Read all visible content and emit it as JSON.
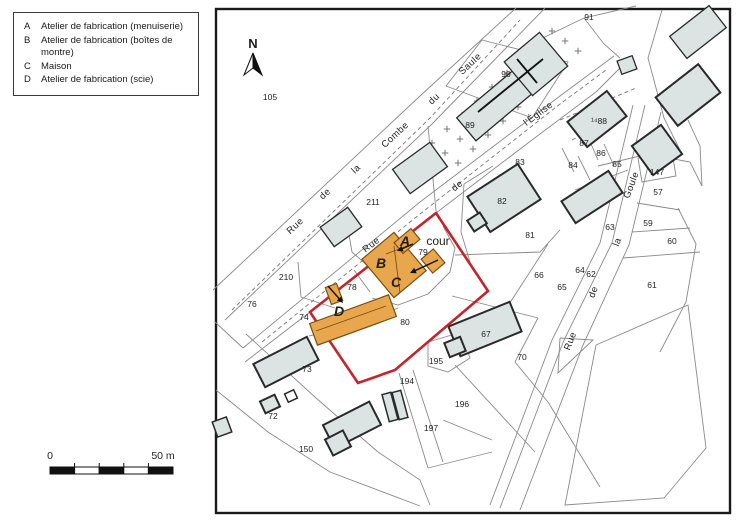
{
  "legend": {
    "items": [
      {
        "key": "A",
        "label": "Atelier de fabrication (menuiserie)"
      },
      {
        "key": "B",
        "label": "Atelier de fabrication (boîtes de montre)"
      },
      {
        "key": "C",
        "label": "Maison"
      },
      {
        "key": "D",
        "label": "Atelier de fabrication (scie)"
      }
    ]
  },
  "north_label": "N",
  "scale_bar": {
    "start_label": "0",
    "end_label": "50 m",
    "x0": 50,
    "x1": 173,
    "y": 467,
    "h": 7,
    "segments": 5
  },
  "colors": {
    "building_gray": "#dbe3e3",
    "building_gray_stroke": "#2a2a2a",
    "building_orange": "#e8a64d",
    "building_orange_stroke": "#7a4f12",
    "outline_red": "#c4242b",
    "parcel_line": "#8a8a8a",
    "frame": "#1a1a1a",
    "cross": "#777777",
    "label": "#1f1f1f"
  },
  "map": {
    "frame": {
      "x": 216,
      "y": 9,
      "w": 514,
      "h": 504
    },
    "red_outline": "436,213 488,291 395,370 358,383 310,312",
    "lines": [
      "213,290 420,96 516,8",
      "225,320 432,124 545,8",
      "243,348 420,202 560,96 614,56",
      "245,362 310,312",
      "436,213 532,140 596,92 624,64",
      "645,105 612,243 564,340 500,508",
      "661,112 629,245 583,345 520,510",
      "633,105 600,243 552,340 490,505",
      "637,203 680,210",
      "632,232 690,228",
      "623,258 700,252",
      "598,166 648,154 690,162 702,186",
      "678,208 696,244 686,302 660,352",
      "522,48 584,18 636,6",
      "584,18 604,44 620,58",
      "662,10 648,58 664,118 680,150",
      "688,120 700,146 702,186",
      "638,158 672,152 676,176 642,182 638,158",
      "493,166 464,184 461,232 470,262",
      "455,255 540,252 560,230",
      "548,244 515,295 492,330",
      "452,296 538,318",
      "538,318 515,362",
      "428,342 462,332 470,358 448,372 428,366 428,342",
      "399,373 428,468",
      "413,370 443,462",
      "443,420 492,440",
      "455,365 535,452",
      "428,468 492,452",
      "515,362 548,402",
      "548,402 600,487",
      "246,334 316,398 378,452",
      "216,390 268,432 330,472 420,506",
      "215,322 243,348",
      "298,262 301,297",
      "301,297 335,308",
      "345,212 352,252 368,266",
      "428,126 436,211",
      "372,298 398,305 428,294 450,272 455,248 443,226",
      "354,270 370,292",
      "309,336 355,325 398,308",
      "446,86 482,40 568,62 532,118 446,86",
      "596,345 688,305 706,448 664,498 565,505 596,345",
      "560,338 593,340 558,373 560,338",
      "588,137 598,160",
      "604,144 614,166",
      "578,156 590,180",
      "562,148 574,172",
      "575,190 628,170",
      "378,452 420,480 430,505"
    ],
    "dashed_lines": [
      "232,310 430,118 520,20",
      "262,342 420,214 560,104 606,70",
      "560,120 636,88",
      "572,140 612,120",
      "398,246 378,262"
    ],
    "crosses": [
      [
        432,
        143
      ],
      [
        447,
        129
      ],
      [
        462,
        115
      ],
      [
        477,
        101
      ],
      [
        492,
        87
      ],
      [
        507,
        73
      ],
      [
        522,
        59
      ],
      [
        537,
        45
      ],
      [
        552,
        31
      ],
      [
        445,
        153
      ],
      [
        460,
        139
      ],
      [
        475,
        125
      ],
      [
        490,
        111
      ],
      [
        505,
        97
      ],
      [
        520,
        83
      ],
      [
        535,
        69
      ],
      [
        550,
        55
      ],
      [
        565,
        41
      ],
      [
        458,
        163
      ],
      [
        473,
        149
      ],
      [
        488,
        135
      ],
      [
        503,
        121
      ],
      [
        518,
        107
      ],
      [
        533,
        93
      ],
      [
        548,
        79
      ],
      [
        563,
        65
      ],
      [
        578,
        51
      ]
    ],
    "gray_buildings": [
      {
        "name": "church-nave",
        "x": 500,
        "y": 101,
        "w": 88,
        "h": 30,
        "a": -40,
        "s": 1.3
      },
      {
        "name": "church-choir",
        "x": 536,
        "y": 64,
        "w": 46,
        "h": 44,
        "a": -40,
        "s": 1.3
      },
      {
        "name": "building-211",
        "x": 420,
        "y": 168,
        "w": 46,
        "h": 30,
        "a": -36,
        "s": 1.3
      },
      {
        "name": "building-210",
        "x": 341,
        "y": 227,
        "w": 34,
        "h": 24,
        "a": -36,
        "s": 1.3
      },
      {
        "name": "building-82",
        "x": 504,
        "y": 198,
        "w": 60,
        "h": 42,
        "a": -33,
        "s": 2
      },
      {
        "name": "building-82-annex",
        "x": 477,
        "y": 222,
        "w": 15,
        "h": 13,
        "a": -33,
        "s": 2
      },
      {
        "name": "building-85",
        "x": 592,
        "y": 197,
        "w": 56,
        "h": 26,
        "a": -33,
        "s": 2
      },
      {
        "name": "building-88",
        "x": 597,
        "y": 119,
        "w": 50,
        "h": 32,
        "a": -38,
        "s": 2
      },
      {
        "name": "building-147",
        "x": 657,
        "y": 150,
        "w": 36,
        "h": 36,
        "a": -36,
        "s": 2
      },
      {
        "name": "building-top-right",
        "x": 698,
        "y": 32,
        "w": 50,
        "h": 28,
        "a": -38,
        "s": 1.3
      },
      {
        "name": "fountain",
        "x": 627,
        "y": 65,
        "w": 16,
        "h": 14,
        "a": -20,
        "s": 1.3
      },
      {
        "name": "building-right-cluster",
        "x": 688,
        "y": 95,
        "w": 54,
        "h": 36,
        "a": -38,
        "s": 2
      },
      {
        "name": "building-67",
        "x": 485,
        "y": 329,
        "w": 66,
        "h": 32,
        "a": -22,
        "s": 2
      },
      {
        "name": "building-67-annex",
        "x": 455,
        "y": 347,
        "w": 17,
        "h": 15,
        "a": -22,
        "s": 2
      },
      {
        "name": "building-73",
        "x": 286,
        "y": 362,
        "w": 60,
        "h": 26,
        "a": -27,
        "s": 2
      },
      {
        "name": "building-72a",
        "x": 270,
        "y": 404,
        "w": 16,
        "h": 13,
        "a": -25,
        "s": 2
      },
      {
        "name": "building-72b",
        "x": 291,
        "y": 396,
        "w": 10,
        "h": 9,
        "a": -25,
        "s": 1.5,
        "fill": "#ffffff"
      },
      {
        "name": "building-150",
        "x": 352,
        "y": 425,
        "w": 52,
        "h": 26,
        "a": -27,
        "s": 2
      },
      {
        "name": "building-150-annex",
        "x": 338,
        "y": 443,
        "w": 20,
        "h": 18,
        "a": -27,
        "s": 2
      },
      {
        "name": "building-194a",
        "x": 390,
        "y": 407,
        "w": 9,
        "h": 28,
        "a": -15,
        "s": 1.5
      },
      {
        "name": "building-194b",
        "x": 400,
        "y": 405,
        "w": 9,
        "h": 28,
        "a": -15,
        "s": 1.5
      },
      {
        "name": "building-southwest",
        "x": 222,
        "y": 427,
        "w": 15,
        "h": 16,
        "a": -20,
        "s": 1.5
      }
    ],
    "church_cross": [
      [
        478,
        112,
        543,
        59
      ],
      [
        517,
        59,
        537,
        83
      ]
    ],
    "orange_buildings": [
      {
        "name": "building-B-C",
        "x": 394,
        "y": 265,
        "w": 42,
        "h": 50,
        "a": -40
      },
      {
        "name": "building-A",
        "x": 407,
        "y": 241,
        "w": 22,
        "h": 14,
        "a": -40
      },
      {
        "name": "building-annex",
        "x": 433,
        "y": 261,
        "w": 16,
        "h": 18,
        "a": -40
      },
      {
        "name": "building-D",
        "x": 353,
        "y": 320,
        "w": 84,
        "h": 23,
        "a": -20
      },
      {
        "name": "building-D-chimney",
        "x": 334,
        "y": 294,
        "w": 12,
        "h": 18,
        "a": -20
      }
    ],
    "internal_lines": [
      [
        394,
        246,
        400,
        293
      ],
      [
        386,
        254,
        412,
        244
      ],
      [
        316,
        331,
        386,
        306
      ]
    ],
    "arrows": [
      [
        413,
        244,
        397,
        251
      ],
      [
        438,
        260,
        410,
        273
      ],
      [
        328,
        286,
        343,
        303
      ]
    ],
    "building_letters": [
      {
        "text": "A",
        "x": 405,
        "y": 246
      },
      {
        "text": "B",
        "x": 381,
        "y": 268
      },
      {
        "text": "C",
        "x": 396,
        "y": 287
      },
      {
        "text": "D",
        "x": 339,
        "y": 316
      }
    ],
    "parcel_labels": [
      {
        "text": "105",
        "x": 270,
        "y": 100
      },
      {
        "text": "91",
        "x": 589,
        "y": 20
      },
      {
        "text": "90",
        "x": 506,
        "y": 77
      },
      {
        "text": "89",
        "x": 470,
        "y": 128
      },
      {
        "text": "¹⁴88",
        "x": 599,
        "y": 124
      },
      {
        "text": "87",
        "x": 584,
        "y": 146
      },
      {
        "text": "86",
        "x": 601,
        "y": 156
      },
      {
        "text": "85",
        "x": 617,
        "y": 167
      },
      {
        "text": "84",
        "x": 573,
        "y": 168
      },
      {
        "text": "147",
        "x": 657,
        "y": 175
      },
      {
        "text": "57",
        "x": 658,
        "y": 195
      },
      {
        "text": "83",
        "x": 520,
        "y": 165
      },
      {
        "text": "82",
        "x": 502,
        "y": 204
      },
      {
        "text": "81",
        "x": 530,
        "y": 238
      },
      {
        "text": "66",
        "x": 539,
        "y": 278
      },
      {
        "text": "65",
        "x": 562,
        "y": 290
      },
      {
        "text": "64",
        "x": 580,
        "y": 273
      },
      {
        "text": "63",
        "x": 610,
        "y": 230
      },
      {
        "text": "62",
        "x": 591,
        "y": 277
      },
      {
        "text": "61",
        "x": 652,
        "y": 288
      },
      {
        "text": "60",
        "x": 672,
        "y": 244
      },
      {
        "text": "59",
        "x": 648,
        "y": 226
      },
      {
        "text": "67",
        "x": 486,
        "y": 337
      },
      {
        "text": "70",
        "x": 522,
        "y": 360
      },
      {
        "text": "195",
        "x": 436,
        "y": 364
      },
      {
        "text": "194",
        "x": 407,
        "y": 384
      },
      {
        "text": "196",
        "x": 462,
        "y": 407
      },
      {
        "text": "197",
        "x": 431,
        "y": 431
      },
      {
        "text": "150",
        "x": 306,
        "y": 452
      },
      {
        "text": "72",
        "x": 273,
        "y": 419
      },
      {
        "text": "73",
        "x": 307,
        "y": 372
      },
      {
        "text": "76",
        "x": 252,
        "y": 307
      },
      {
        "text": "210",
        "x": 286,
        "y": 280
      },
      {
        "text": "211",
        "x": 373,
        "y": 205
      },
      {
        "text": "74",
        "x": 304,
        "y": 320
      },
      {
        "text": "78",
        "x": 352,
        "y": 290
      },
      {
        "text": "79",
        "x": 423,
        "y": 255
      },
      {
        "text": "80",
        "x": 405,
        "y": 325
      }
    ],
    "cour_label": {
      "text": "cour",
      "x": 438,
      "y": 245
    },
    "street_labels": [
      {
        "text": "Rue",
        "x": 297,
        "y": 228,
        "a": -43
      },
      {
        "text": "de",
        "x": 327,
        "y": 196,
        "a": -43
      },
      {
        "text": "la",
        "x": 358,
        "y": 171,
        "a": -43
      },
      {
        "text": "Combe",
        "x": 397,
        "y": 137,
        "a": -43
      },
      {
        "text": "du",
        "x": 436,
        "y": 101,
        "a": -43
      },
      {
        "text": "Saule",
        "x": 472,
        "y": 66,
        "a": -43
      },
      {
        "text": "Rue",
        "x": 373,
        "y": 247,
        "a": -38
      },
      {
        "text": "de",
        "x": 459,
        "y": 188,
        "a": -38
      },
      {
        "text": "l'Église",
        "x": 540,
        "y": 116,
        "a": -37
      },
      {
        "text": "Rue",
        "x": 573,
        "y": 342,
        "a": -69
      },
      {
        "text": "de",
        "x": 596,
        "y": 293,
        "a": -69
      },
      {
        "text": "la",
        "x": 620,
        "y": 243,
        "a": -69
      },
      {
        "text": "Goule",
        "x": 634,
        "y": 186,
        "a": -69
      }
    ],
    "north": {
      "x": 253,
      "y": 48
    }
  }
}
